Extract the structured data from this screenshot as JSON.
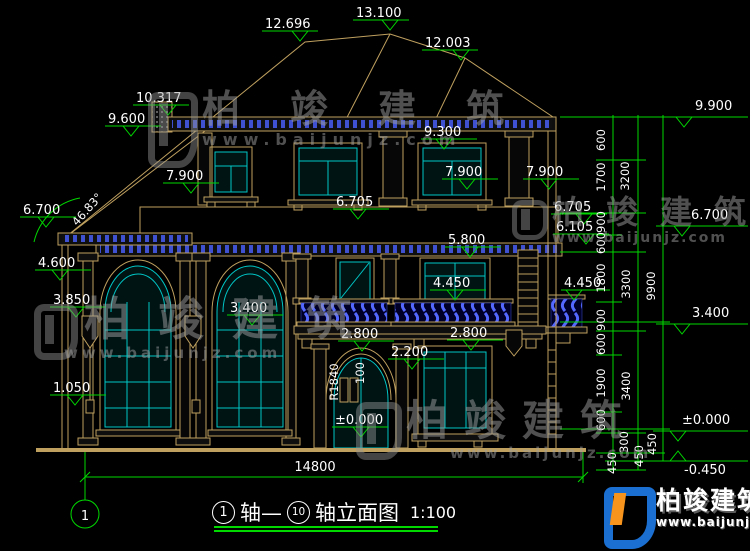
{
  "colors": {
    "background": "#000000",
    "drawing_line_tan": "#bfa05f",
    "glazing_cyan": "#00c6c6",
    "dimension_green": "#00d800",
    "text_white": "#ffffff",
    "detail_blue": "#3f51d0",
    "watermark_gray": "#a0a0a0",
    "logo_blue": "#1b6fd0",
    "logo_orange": "#f7941d"
  },
  "watermark": {
    "brand": "柏竣建筑",
    "url": "www.baijunjz.com"
  },
  "logo": {
    "brand": "柏竣建筑",
    "url": "www.baijunjz.com"
  },
  "title": {
    "axis_start": "1",
    "joiner": "轴—",
    "axis_end": "10",
    "name": "轴立面图",
    "scale": "1:100"
  },
  "texts": {
    "total_width": "14800",
    "radius": "R1840",
    "door_width": "100",
    "roof_angle": "46.83°"
  },
  "annotations": {
    "axis_bubble": "1",
    "markers": [
      {
        "label": "12.696",
        "x": 265,
        "y": 28,
        "ax": 300
      },
      {
        "label": "13.100",
        "x": 356,
        "y": 17,
        "ax": 390
      },
      {
        "label": "12.003",
        "x": 425,
        "y": 47,
        "ax": 461
      },
      {
        "label": "10.317",
        "x": 136,
        "y": 102,
        "ax": 168
      },
      {
        "label": "9.600",
        "x": 108,
        "y": 123,
        "ax": 131
      },
      {
        "label": "9.300",
        "x": 424,
        "y": 136,
        "ax": 444
      },
      {
        "label": "7.900",
        "x": 166,
        "y": 180,
        "ax": 191
      },
      {
        "label": "7.900",
        "x": 445,
        "y": 176,
        "ax": 467
      },
      {
        "label": "7.900",
        "x": 526,
        "y": 176,
        "ax": 549
      },
      {
        "label": "6.700",
        "x": 23,
        "y": 214,
        "ax": 46
      },
      {
        "label": "6.705",
        "x": 336,
        "y": 206,
        "ax": 358
      },
      {
        "label": "6.705",
        "x": 554,
        "y": 211,
        "ax": 584
      },
      {
        "label": "6.105",
        "x": 556,
        "y": 231,
        "ax": 586
      },
      {
        "label": "5.800",
        "x": 448,
        "y": 244,
        "ax": 470
      },
      {
        "label": "4.600",
        "x": 38,
        "y": 267,
        "ax": 60
      },
      {
        "label": "3.850",
        "x": 53,
        "y": 304,
        "ax": 76
      },
      {
        "label": "3.400",
        "x": 230,
        "y": 312,
        "ax": 252
      },
      {
        "label": "4.450",
        "x": 433,
        "y": 287,
        "ax": 455
      },
      {
        "label": "4.450",
        "x": 564,
        "y": 287,
        "ax": 574,
        "x1": 561,
        "x2": 610
      },
      {
        "label": "2.800",
        "x": 341,
        "y": 338,
        "ax": 362
      },
      {
        "label": "2.800",
        "x": 450,
        "y": 337,
        "ax": 471
      },
      {
        "label": "2.200",
        "x": 391,
        "y": 356,
        "ax": 412
      },
      {
        "label": "1.050",
        "x": 53,
        "y": 392,
        "ax": 75
      },
      {
        "label": "±0.000",
        "x": 335,
        "y": 424,
        "ax": 361
      },
      {
        "label": "9.900",
        "x": 695,
        "y": 110,
        "ax": 684,
        "x1": 658,
        "x2": 748,
        "ly": 117
      },
      {
        "label": "6.700",
        "x": 691,
        "y": 219,
        "ax": 682,
        "x1": 656,
        "x2": 748,
        "ly": 226
      },
      {
        "label": "3.400",
        "x": 692,
        "y": 317,
        "ax": 682,
        "x1": 656,
        "x2": 748,
        "ly": 324
      },
      {
        "label": "±0.000",
        "x": 682,
        "y": 424,
        "ax": 678,
        "x1": 653,
        "x2": 748,
        "ly": 431
      },
      {
        "label": "-0.450",
        "x": 684,
        "y": 474,
        "ax": 678,
        "x1": 653,
        "x2": 748,
        "ly": 461,
        "dir": "up"
      }
    ],
    "chain_labels": [
      {
        "label": "600",
        "x": 605,
        "y": 140
      },
      {
        "label": "1700",
        "x": 605,
        "y": 177
      },
      {
        "label": "900",
        "x": 605,
        "y": 222
      },
      {
        "label": "600",
        "x": 605,
        "y": 243
      },
      {
        "label": "1800",
        "x": 605,
        "y": 278
      },
      {
        "label": "900",
        "x": 605,
        "y": 320
      },
      {
        "label": "600",
        "x": 605,
        "y": 344
      },
      {
        "label": "1900",
        "x": 605,
        "y": 383
      },
      {
        "label": "600",
        "x": 605,
        "y": 420
      },
      {
        "label": "300",
        "x": 628,
        "y": 442
      },
      {
        "label": "450",
        "x": 616,
        "y": 463
      },
      {
        "label": "450",
        "x": 643,
        "y": 456
      },
      {
        "label": "450",
        "x": 656,
        "y": 444
      },
      {
        "label": "3200",
        "x": 629,
        "y": 176
      },
      {
        "label": "3300",
        "x": 630,
        "y": 284
      },
      {
        "label": "3400",
        "x": 630,
        "y": 386
      },
      {
        "label": "9900",
        "x": 655,
        "y": 286
      }
    ]
  }
}
